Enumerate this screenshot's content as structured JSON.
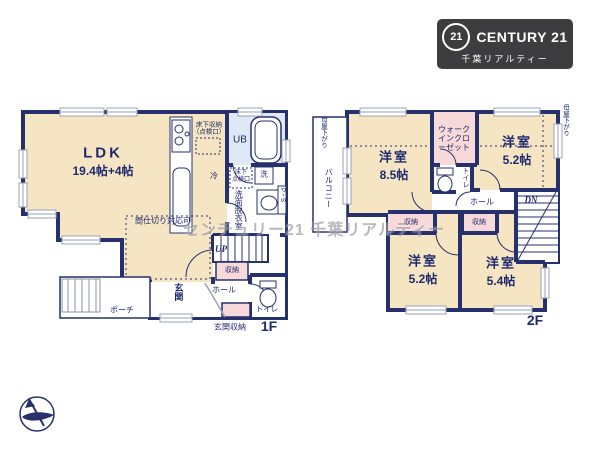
{
  "watermark": "センチュリー21 千葉リアルティー",
  "logo": {
    "seal": "21",
    "brand": "CENTURY 21",
    "subtitle": "千葉リアルティー"
  },
  "colors": {
    "wall": "#25306d",
    "room_cream": "#f6e5c3",
    "closet_pink": "#f8d9d9",
    "bath_blue": "#dfe9f5",
    "logo_bg": "#3d3d40",
    "label_navy": "#1f2a6e"
  },
  "floor1": {
    "label": "1F",
    "ldk_name": "LDK",
    "ldk_size": "19.4帖+4帖",
    "partition_note": "間仕切り対応可",
    "floor_storage": "床下収納\n（点検口）",
    "floor_hatch": "床下\n点検口",
    "fridge": "冷",
    "washer": "洗",
    "bath": "UB",
    "washroom": "洗面脱衣室",
    "pipe_space": "P・S",
    "stairs_up": "UP",
    "closet": "収納",
    "entrance": "玄関",
    "hall": "ホール",
    "toilet": "トイレ",
    "porch": "ポーチ",
    "entrance_storage": "玄関収納"
  },
  "floor2": {
    "label": "2F",
    "bedroom1_name": "洋室",
    "bedroom1_size": "8.5帖",
    "bedroom2_name": "洋室",
    "bedroom2_size": "5.2帖",
    "bedroom3_name": "洋室",
    "bedroom3_size": "5.2帖",
    "bedroom4_name": "洋室",
    "bedroom4_size": "5.4帖",
    "wic": "ウォークインクローゼット",
    "toilet": "トイレ",
    "hall": "ホール",
    "stairs_down": "DN",
    "closet1": "収納",
    "closet2": "収納",
    "balcony": "バルコニー",
    "eaves_left": "母屋下がり",
    "eaves_right": "母屋下がり"
  }
}
